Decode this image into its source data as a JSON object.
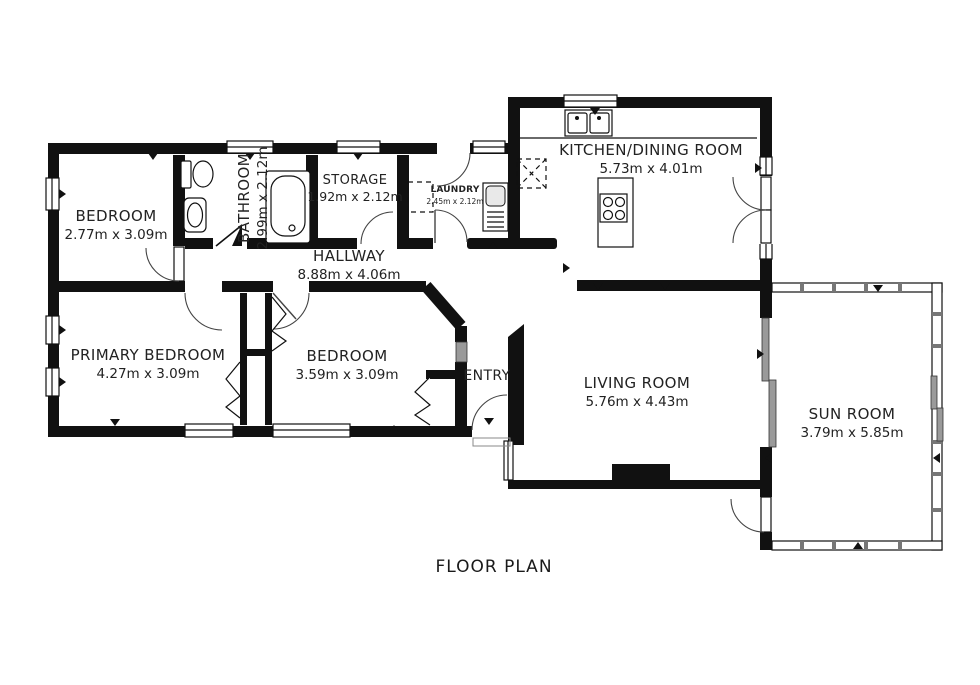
{
  "title": "FLOOR PLAN",
  "rooms": [
    {
      "id": "bedroom-top",
      "name": "BEDROOM",
      "dims": "2.77m x 3.09m"
    },
    {
      "id": "bathroom",
      "name": "BATHROOM",
      "dims": "2.99m x 2.12m"
    },
    {
      "id": "storage",
      "name": "STORAGE",
      "dims": "1.92m x 2.12m"
    },
    {
      "id": "laundry",
      "name": "LAUNDRY",
      "dims": "2.45m x 2.12m"
    },
    {
      "id": "kitchen-dining",
      "name": "KITCHEN/DINING ROOM",
      "dims": "5.73m x 4.01m"
    },
    {
      "id": "hallway",
      "name": "HALLWAY",
      "dims": "8.88m x 4.06m"
    },
    {
      "id": "primary-bedroom",
      "name": "PRIMARY BEDROOM",
      "dims": "4.27m x 3.09m"
    },
    {
      "id": "bedroom-middle",
      "name": "BEDROOM",
      "dims": "3.59m x 3.09m"
    },
    {
      "id": "entry",
      "name": "ENTRY",
      "dims": ""
    },
    {
      "id": "living-room",
      "name": "LIVING ROOM",
      "dims": "5.76m x 4.43m"
    },
    {
      "id": "sun-room",
      "name": "SUN ROOM",
      "dims": "3.79m x 5.85m"
    }
  ],
  "colors": {
    "wall": "#111111",
    "text": "#222222",
    "window_glass": "#9a9a9a",
    "background": "#ffffff"
  }
}
